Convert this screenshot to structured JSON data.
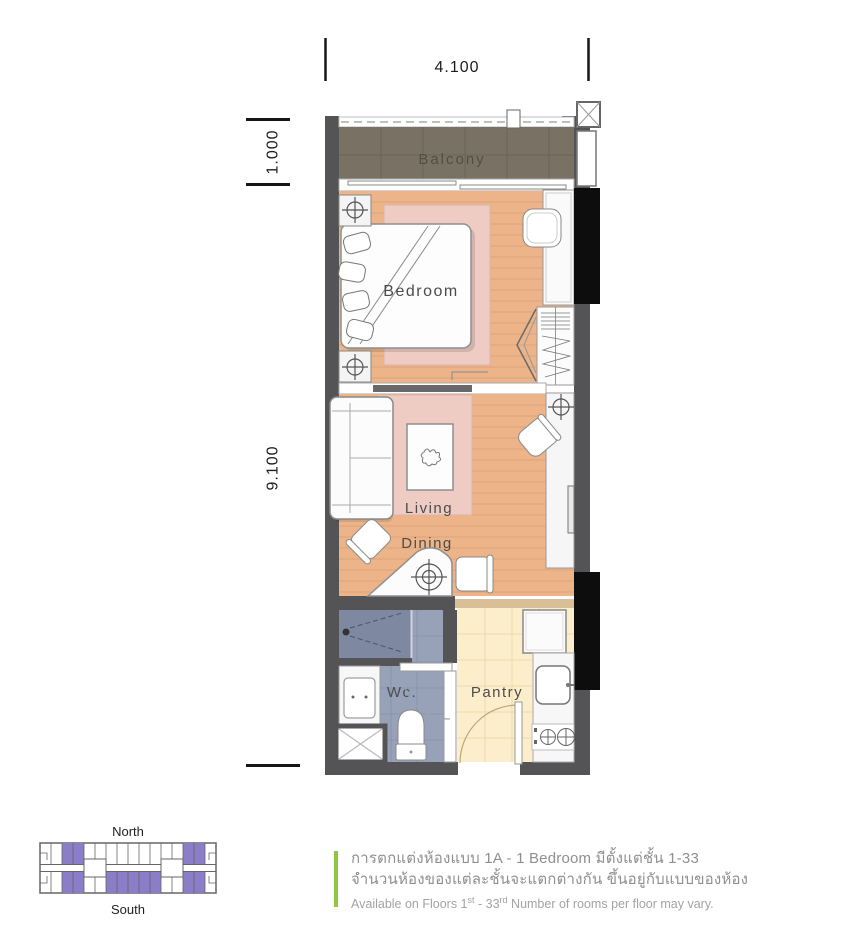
{
  "dimensions": {
    "top_width": "4.100",
    "balcony_depth": "1.000",
    "unit_length": "9.100"
  },
  "rooms": {
    "balcony": "Balcony",
    "bedroom": "Bedroom",
    "living": "Living",
    "dining": "Dining",
    "wc": "Wc.",
    "pantry": "Pantry"
  },
  "keyplan": {
    "north_label": "North",
    "south_label": "South"
  },
  "notes": {
    "line1_thai": "การตกแต่งห้องแบบ 1A - 1 Bedroom มีตั้งแต่ชั้น 1-33",
    "line2_thai": "จำนวนห้องของแต่ละชั้นจะแตกต่างกัน ขึ้นอยู่กับแบบของห้อง",
    "line3": {
      "prefix": "Available on Floors 1",
      "sup1": "st",
      "mid": " - 33",
      "sup2": "rd",
      "suffix": " Number of rooms per floor may vary."
    }
  },
  "colors": {
    "wall": "#545456",
    "balcony_floor": "#797264",
    "wood_floor": "#ecb488",
    "plank_line": "#d89f72",
    "rug": "#eeccc4",
    "wc_tile": "#97a2b8",
    "wc_shower": "#7e89a1",
    "pantry_floor": "#fdeecb",
    "pantry_wall": "#d9bf97",
    "column": "#0d0d0d",
    "keyplan_unit": "#8b7dc7",
    "accent_green": "#8dc63f",
    "note_text": "#8f8f8f",
    "note_subtext": "#a3a3a3"
  },
  "icons": {
    "ceiling_light": "crosshair-circle",
    "column_marker": "x-cross-box",
    "shower_head": "dot-with-spray-lines",
    "stove_burners": "circles-with-cross",
    "plant": "scribble-leaf"
  }
}
